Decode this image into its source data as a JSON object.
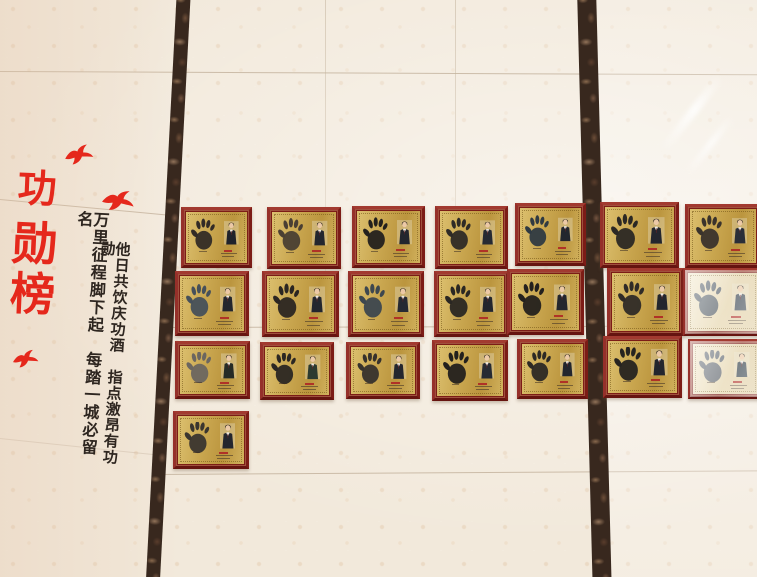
{
  "title": {
    "text": "功勋榜",
    "chars": [
      "功",
      "勋",
      "榜"
    ],
    "color": "#e5281c"
  },
  "couplet": {
    "left_column": "万里征程脚下起　每踏一城必留名",
    "right_column": "他日共饮庆功酒　指点激昂有功勋",
    "color": "#2e2620"
  },
  "decor": {
    "bird_count": 3,
    "bird_color": "#e5281c"
  },
  "wall": {
    "tile_color": "#f2e9db",
    "seam_color": "#baa892",
    "marble_strip_color": "#38281e",
    "marble_strip_count": 2
  },
  "plaques": {
    "total": 22,
    "frame_color": "#8e241f",
    "plate_color": "#c9a64f",
    "caption_color": "#b03227",
    "rows": [
      {
        "plaques": [
          {
            "hand": "#322b26",
            "suit": "#1f222b",
            "glare": false
          },
          {
            "hand": "#4a3f33",
            "suit": "#23262e",
            "glare": false
          },
          {
            "hand": "#23201d",
            "suit": "#23262e",
            "glare": false
          },
          {
            "hand": "#2e2a26",
            "suit": "#262a33",
            "glare": false
          },
          {
            "hand": "#2f3a42",
            "suit": "#23262e",
            "glare": false
          },
          {
            "hand": "#2b2824",
            "suit": "#23262e",
            "glare": false
          },
          {
            "hand": "#3a332c",
            "suit": "#2a2e38",
            "glare": false
          }
        ]
      },
      {
        "plaques": [
          {
            "hand": "#46505a",
            "suit": "#23262e",
            "glare": false
          },
          {
            "hand": "#2b2622",
            "suit": "#23262e",
            "glare": false
          },
          {
            "hand": "#3d474f",
            "suit": "#262a33",
            "glare": false
          },
          {
            "hand": "#2a2723",
            "suit": "#23262e",
            "glare": false
          },
          {
            "hand": "#24211e",
            "suit": "#23262e",
            "glare": false
          },
          {
            "hand": "#2f2b27",
            "suit": "#23262e",
            "glare": false
          },
          {
            "hand": "#4a545e",
            "suit": "#3c4752",
            "glare": true
          }
        ]
      },
      {
        "plaques": [
          {
            "hand": "#6b6660",
            "suit": "#262b26",
            "glare": false
          },
          {
            "hand": "#2b2723",
            "suit": "#2c3a30",
            "glare": false
          },
          {
            "hand": "#36322d",
            "suit": "#23262e",
            "glare": false
          },
          {
            "hand": "#23201d",
            "suit": "#262a33",
            "glare": false
          },
          {
            "hand": "#2c2925",
            "suit": "#23262e",
            "glare": false
          },
          {
            "hand": "#262320",
            "suit": "#23262e",
            "glare": false
          },
          {
            "hand": "#555d66",
            "suit": "#334049",
            "glare": true
          }
        ]
      },
      {
        "plaques": [
          {
            "hand": "#3a352f",
            "suit": "#23262e",
            "glare": false
          }
        ]
      }
    ]
  }
}
